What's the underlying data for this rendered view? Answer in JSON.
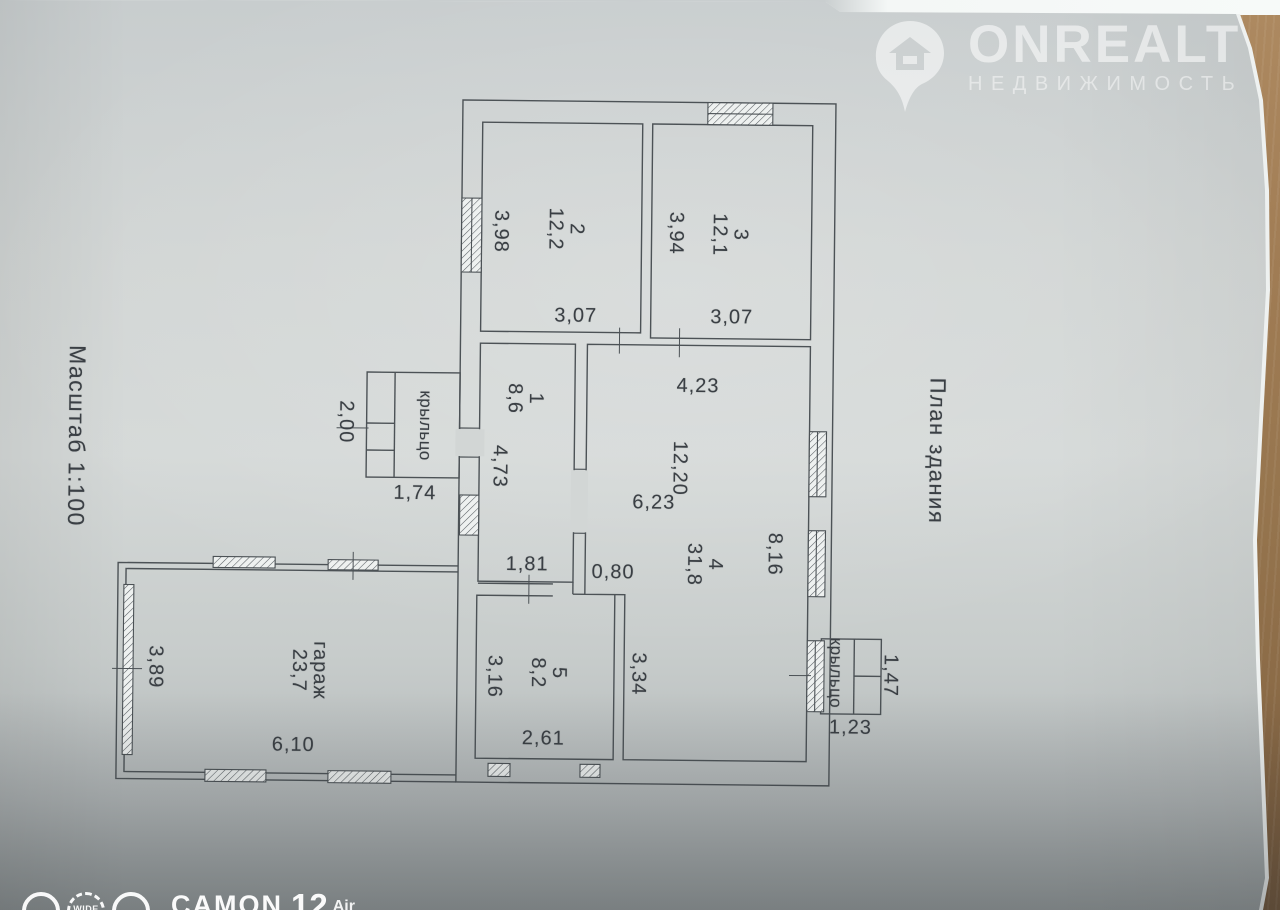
{
  "titles": {
    "scale": "Масштаб 1:100",
    "plan": "План здания"
  },
  "rooms": {
    "room1": {
      "number": "1",
      "area": "8,6",
      "dim_height": "4,73",
      "dim_width": "1,81"
    },
    "room2": {
      "number": "2",
      "area": "12,2",
      "dim_height": "3,98",
      "dim_width": "3,07"
    },
    "room3": {
      "number": "3",
      "area": "12,1",
      "dim_height": "3,94",
      "dim_width": "3,07"
    },
    "room4": {
      "number": "4",
      "area": "31,8",
      "dim_top": "4,23",
      "dim_middle": "12,20",
      "dim_inner": "6,23",
      "dim_nook": "0,80",
      "dim_right": "8,16",
      "dim_lower": "3,34"
    },
    "room5": {
      "number": "5",
      "area": "8,2",
      "dim_height": "3,16",
      "dim_width": "2,61"
    },
    "garage": {
      "name": "гараж",
      "area": "23,7",
      "dim_height": "3,89",
      "dim_width": "6,10"
    },
    "porch_left": {
      "name": "крыльцо",
      "dim_height": "2,00",
      "dim_width": "1,74"
    },
    "porch_right": {
      "name": "крыльцо",
      "dim_height": "1,47",
      "dim_width": "1,23"
    }
  },
  "watermark_logo": {
    "brand": "ONREALT",
    "subtitle": "НЕДВИЖИМОСТЬ",
    "icon": "house-location-pin"
  },
  "camera_watermark": {
    "wide_label": "WIDE",
    "brand": "CAMON",
    "model": "12",
    "suffix": "Air",
    "icons": [
      "camera-lens-icon",
      "wide-lens-dashed-icon",
      "camera-lens-icon"
    ]
  },
  "colors": {
    "paper": "#d2d6d5",
    "wood": "#9a7750",
    "plan_line": "#4c5256",
    "text": "#3a3f44",
    "watermark_white": "rgba(255,255,255,0.55)"
  }
}
